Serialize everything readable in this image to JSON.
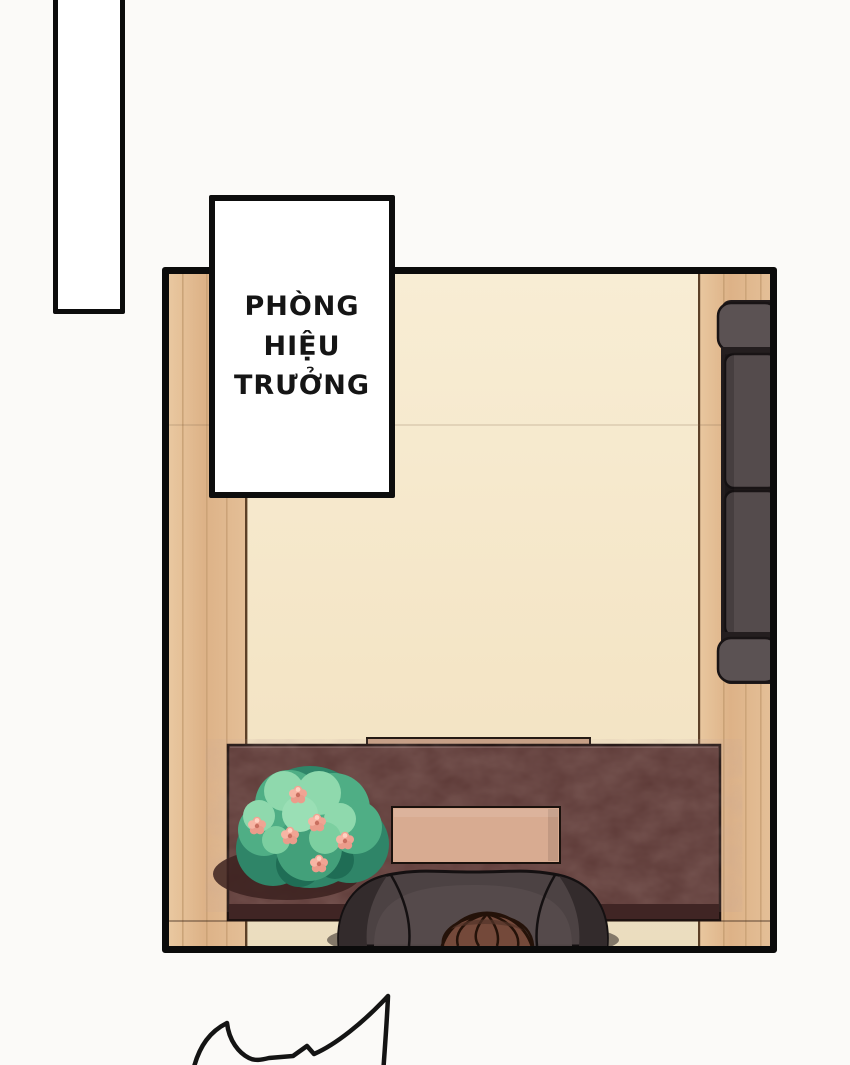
{
  "label_box": {
    "text": "PHÒNG\nHIỆU\nTRƯỞNG"
  },
  "scene": {
    "description": "top-down manga panel of a principal's office",
    "objects": [
      "wood-wall-left",
      "back-wall",
      "wood-wall-right",
      "wall-seam",
      "sofa",
      "desk",
      "desk-tray",
      "desk-blotter",
      "flower-bush",
      "office-chair",
      "person-hair",
      "floor"
    ],
    "colors": {
      "page_background": "#fbfaf8",
      "panel_border": "#0b0b0b",
      "wood": "#e2bc93",
      "wood_grain": "#c49c70",
      "wall_cream": "#f6e8cc",
      "floor_cream": "#eadec2",
      "desk": "#5d3a37",
      "desk_front": "#402524",
      "desk_tray": "#c7a084",
      "desk_blotter": "#d8ab91",
      "sofa": "#574e4f",
      "sofa_armrest": "#5b5253",
      "chair": "#4c4243",
      "chair_wing": "#332b2c",
      "hair": "#74493a",
      "plant_leaf_light": "#8fd9ad",
      "plant_leaf": "#4fae85",
      "plant_leaf_dark": "#2f8568",
      "plant_flower": "#f0a493",
      "outline_ink": "#141011"
    }
  },
  "speech_bubble_fragment": {
    "shape": "spiky-bubble-edge",
    "stroke": "#141414"
  }
}
